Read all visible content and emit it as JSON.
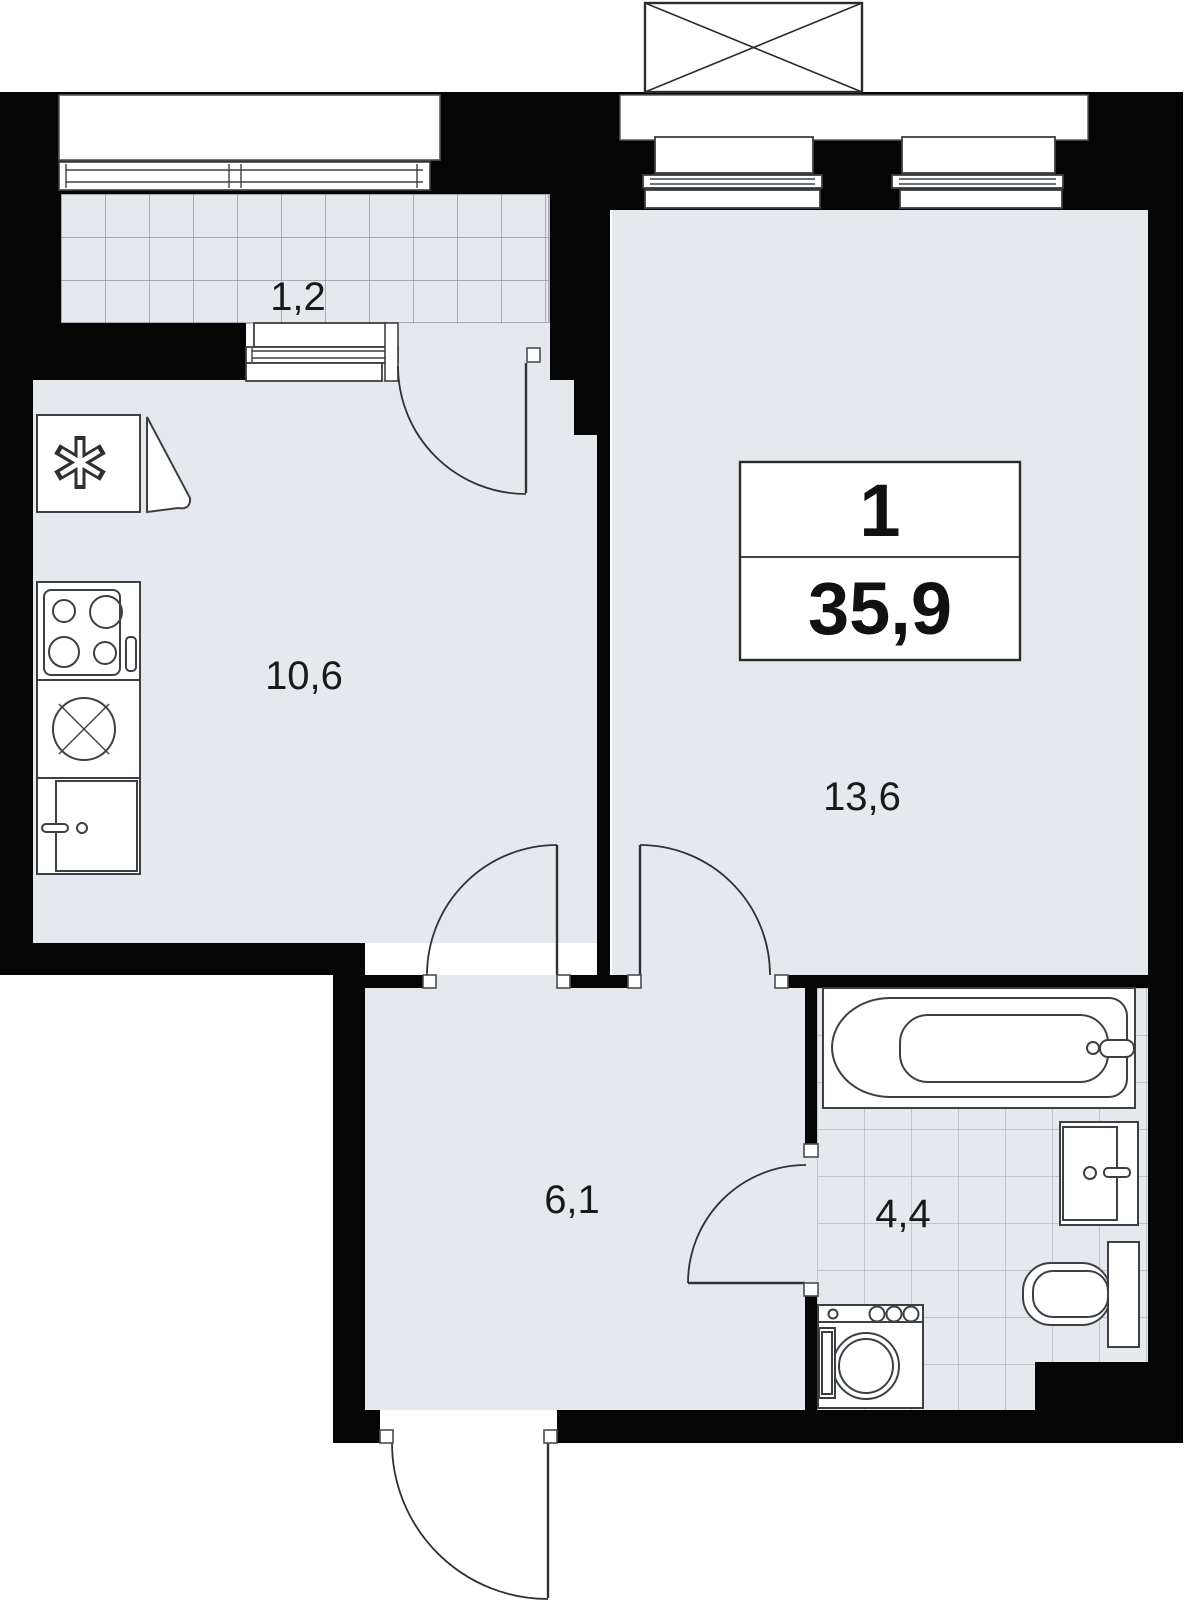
{
  "plan": {
    "type": "apartment-floor-plan",
    "info_box": {
      "rooms_count": "1",
      "total_area": "35,9"
    },
    "rooms": [
      {
        "id": "balcony",
        "label": "1,2"
      },
      {
        "id": "kitchen",
        "label": "10,6"
      },
      {
        "id": "living-room",
        "label": "13,6"
      },
      {
        "id": "hallway",
        "label": "6,1"
      },
      {
        "id": "bathroom",
        "label": "4,4"
      }
    ],
    "colors": {
      "wall": "#050505",
      "floor": "#e5e8ec",
      "fixture_stroke": "#3d4043",
      "balcony_grid": "#84898f",
      "bathroom_grid": "#a9aeb4",
      "background": "#ffffff"
    }
  }
}
